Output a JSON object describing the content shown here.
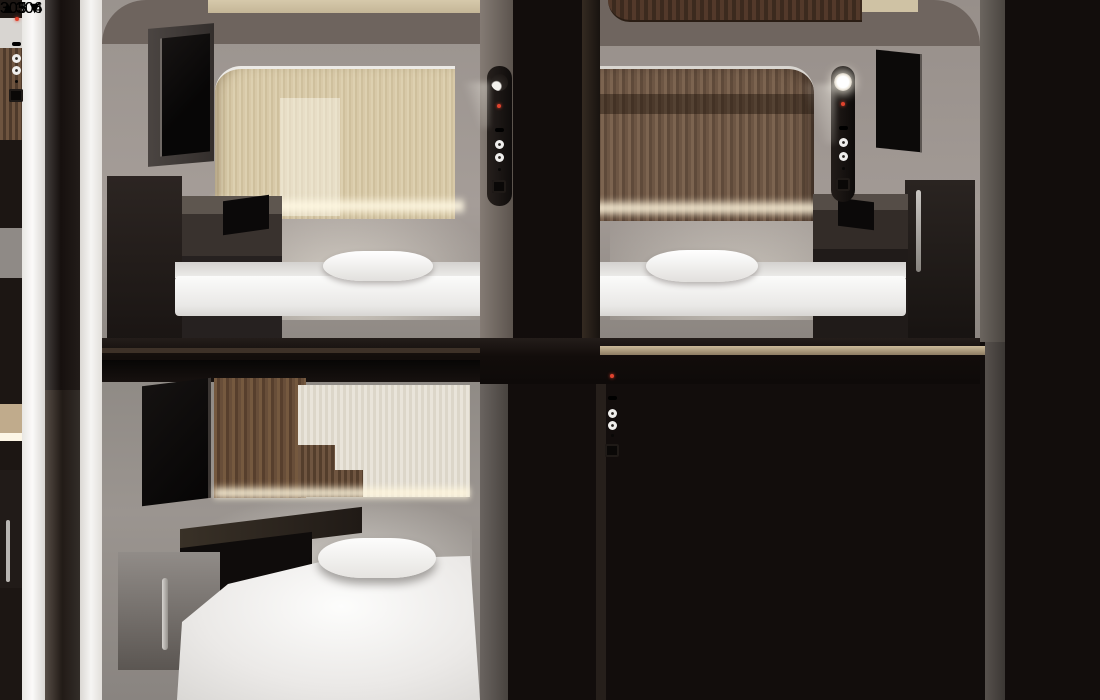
{
  "scene": {
    "kind": "capsule-hotel-pods-photo",
    "tiers": [
      "upper",
      "lower"
    ],
    "colors": {
      "frame_white": "#f4f3f1",
      "shell_dark": "#120d0c",
      "wall_gray": "#97908b",
      "wood_light": "#d8c9a8",
      "wood_dark": "#6d5644",
      "plate_silver": "#d6d5d3",
      "pill_white": "#fdfdfc",
      "label_text": "#2a2724",
      "led_red": "#e0432e",
      "handle_taupe": "#685f57",
      "rung_gray": "#d8d6d3",
      "mattress_white": "#f6f5f3"
    }
  },
  "plates": {
    "left": {
      "up": {
        "arrow": "▲",
        "number": "306"
      },
      "down": {
        "number": "305",
        "arrow": "▼"
      }
    },
    "right": {
      "up": {
        "arrow": "▲",
        "number": "304"
      },
      "down": {
        "number": "303",
        "arrow": "▼"
      }
    }
  }
}
